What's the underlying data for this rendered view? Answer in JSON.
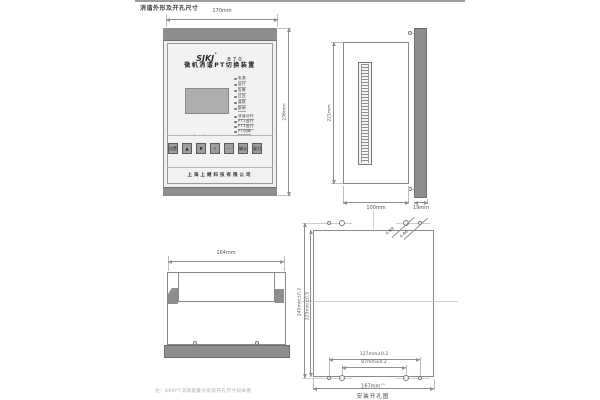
{
  "page": {
    "title": "消谐外形及开孔尺寸",
    "note": "注：860PT消谐装置外形及开孔尺寸同本图",
    "colors": {
      "metal_gray": "#8e8e8e",
      "line_gray": "#8f8f8f"
    }
  },
  "front_view": {
    "dim_width": "170mm",
    "dim_height": "236mm",
    "brand": "SJKJ",
    "brand_reg": "®",
    "model": "870",
    "device_name": "微机消谐PT切换装置",
    "company": "上海上继科技有限公司",
    "leds": [
      "电源",
      "运行",
      "告警",
      "过压",
      "谐振",
      "跳闸",
      "消谐动作",
      "PT1运行",
      "PT2运行",
      "PT切换"
    ],
    "buttons": [
      "设置",
      "▲",
      "▼",
      "＋",
      "－",
      "确认",
      "复归"
    ]
  },
  "side_view": {
    "dim_height": "221mm",
    "dim_depth": "100mm",
    "dim_bezel": "19mm"
  },
  "top_view": {
    "dim_width": "164mm"
  },
  "mounting_view": {
    "caption": "安装开孔图",
    "dim_height_outer": "240mm±0.2",
    "dim_height_cutout": "225mm±0.5",
    "dim_holes_outer": "127mm±0.2",
    "dim_holes_inner": "87mm±0.2",
    "dim_width_cutout": "167mm",
    "dim_width_cutout_tol": "+1",
    "hole_label_large": "4-Φ9",
    "hole_label_small": "4-Φ6"
  }
}
